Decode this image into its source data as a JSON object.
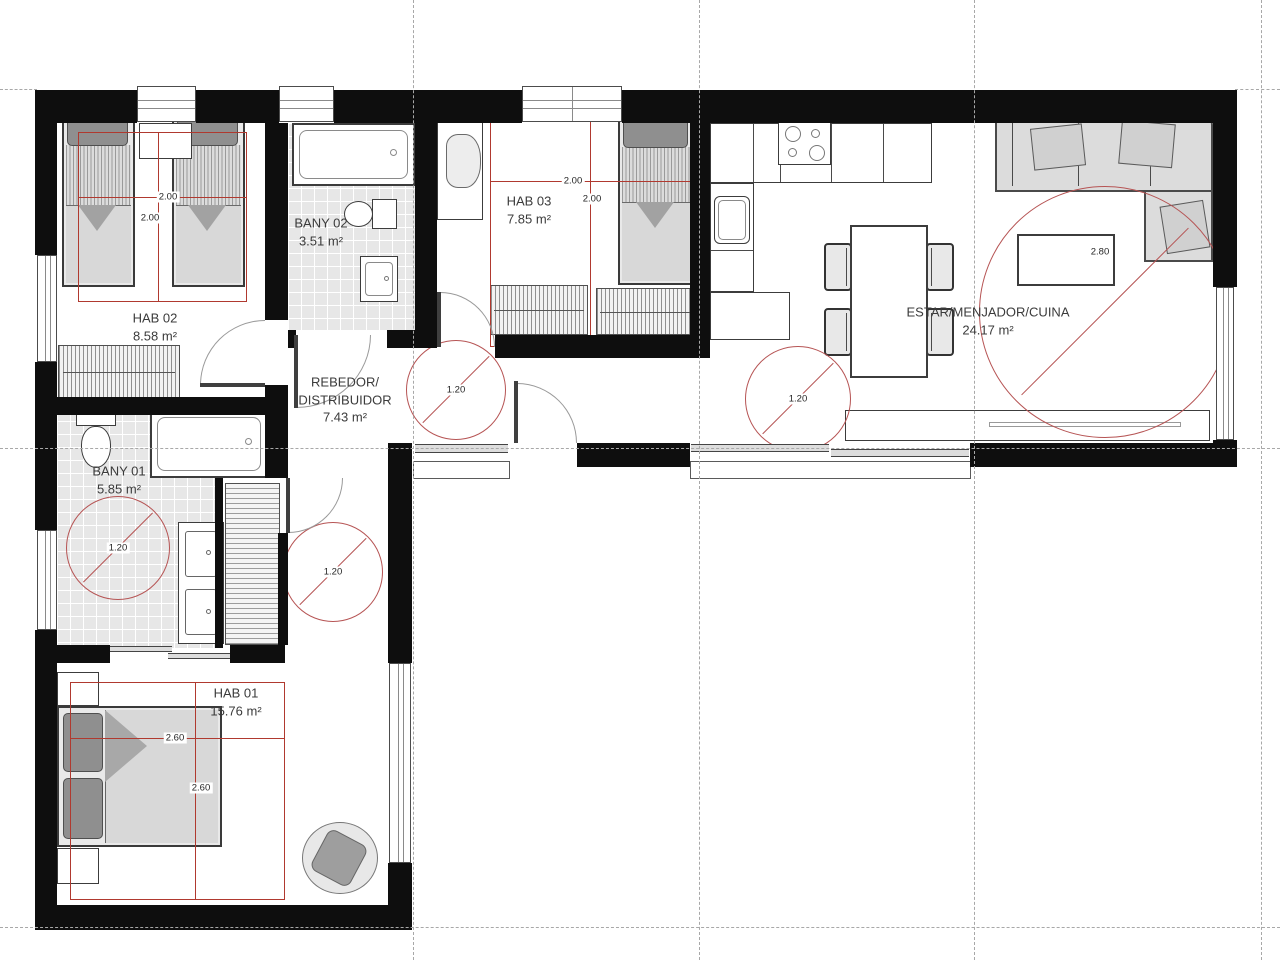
{
  "rooms": {
    "hab02": {
      "name": "HAB 02",
      "area": "8.58 m²"
    },
    "bany02": {
      "name": "BANY 02",
      "area": "3.51 m²"
    },
    "hab03": {
      "name": "HAB 03",
      "area": "7.85 m²"
    },
    "estar": {
      "name": "ESTAR/MENJADOR/CUINA",
      "area": "24.17 m²"
    },
    "rebedor": {
      "name_line1": "REBEDOR/",
      "name_line2": "DISTRIBUIDOR",
      "area": "7.43 m²"
    },
    "bany01": {
      "name": "BANY 01",
      "area": "5.85 m²"
    },
    "hab01": {
      "name": "HAB 01",
      "area": "15.76 m²"
    }
  },
  "dimensions": {
    "hab02_width": "2.00",
    "hab02_depth": "2.00",
    "hab03_width": "2.00",
    "hab03_depth": "2.00",
    "hab01_width": "2.60",
    "hab01_depth": "2.60",
    "turning_circle": "1.20",
    "living_circle": "2.80"
  },
  "colors": {
    "wall": "#0e0e0e",
    "dimension_red": "#b0392f",
    "circle_red": "#b65454"
  }
}
